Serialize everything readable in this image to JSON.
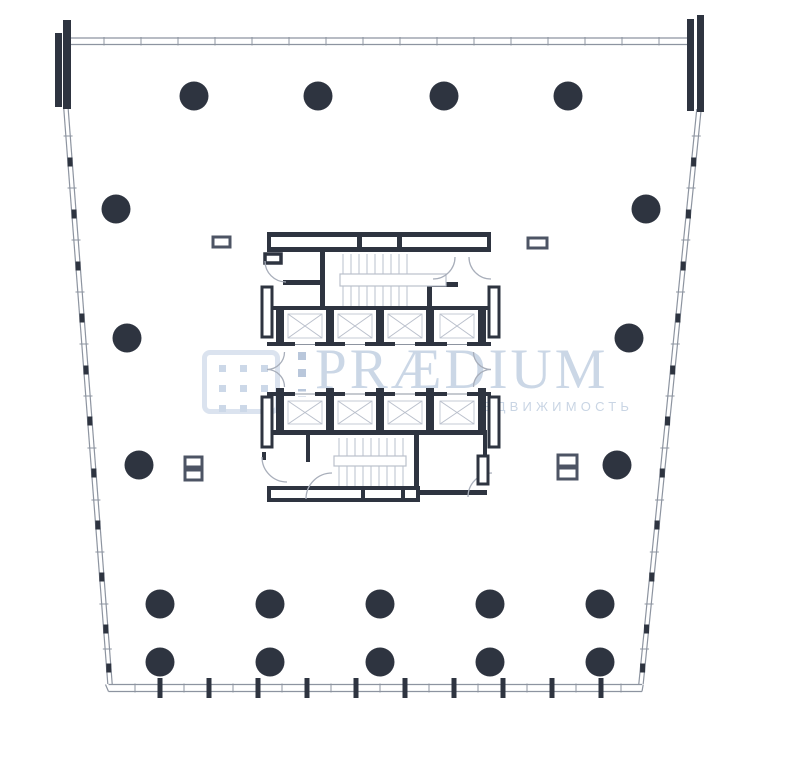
{
  "watermark": {
    "title": "PRÆDIUM",
    "subtitle": "КОММЕРЧЕСКАЯ НЕДВИЖИМОСТЬ",
    "logo": {
      "name": "praedium-building-grid-logo",
      "grid_rows": 3,
      "grid_cols": 3,
      "dot_size": 7,
      "grid_x0": 12,
      "grid_y0": 10,
      "grid_dx": 21,
      "grid_dy": 20,
      "strip_x": 298,
      "strip_dot_size": 8,
      "strip_ys": [
        352,
        369,
        389,
        405
      ]
    }
  },
  "colors": {
    "background": "#ffffff",
    "wall_dark": "#2e3440",
    "glazing_line": "#8d94a0",
    "detail_gray": "#bac0cc",
    "shaft_inner": "#c5cbd6",
    "vent_stroke": "#4d5464",
    "watermark_blue": "#cbd7e6"
  },
  "plan": {
    "column_radius": 14.5,
    "columns": [
      [
        194,
        96
      ],
      [
        318,
        96
      ],
      [
        444,
        96
      ],
      [
        568,
        96
      ],
      [
        116,
        209
      ],
      [
        646,
        209
      ],
      [
        127,
        338
      ],
      [
        629,
        338
      ],
      [
        139,
        465
      ],
      [
        617,
        465
      ],
      [
        160,
        604
      ],
      [
        270,
        604
      ],
      [
        380,
        604
      ],
      [
        490,
        604
      ],
      [
        600,
        604
      ],
      [
        160,
        662
      ],
      [
        270,
        662
      ],
      [
        380,
        662
      ],
      [
        490,
        662
      ],
      [
        600,
        662
      ]
    ],
    "perimeter": {
      "left": {
        "x0": 66,
        "y0": 109,
        "x1": 110,
        "y1": 684
      },
      "right": {
        "x0": 699,
        "y0": 109,
        "x1": 641,
        "y1": 684
      },
      "top_ticks_x": [
        104,
        141,
        178,
        215,
        252,
        289,
        326,
        363,
        400,
        437,
        474,
        511,
        548,
        585,
        622,
        659
      ],
      "bottom_ticks_light_x": [
        135,
        184,
        233,
        282,
        331,
        380,
        429,
        478,
        527,
        576,
        621
      ],
      "bottom_ticks_dark_x": [
        160,
        209,
        258,
        307,
        356,
        405,
        454,
        503,
        552,
        601
      ],
      "side_ticks_light_y": [
        136,
        188,
        240,
        292,
        344,
        396,
        448,
        500,
        552,
        604,
        649
      ],
      "side_ticks_dark_y": [
        162,
        214,
        266,
        318,
        370,
        421,
        473,
        525,
        577,
        629,
        668
      ]
    },
    "wall_bars": [
      [
        55,
        33,
        7,
        74
      ],
      [
        63,
        20,
        8,
        89
      ],
      [
        687,
        19,
        7,
        92
      ],
      [
        697,
        15,
        7,
        97
      ]
    ],
    "elevator_banks": [
      {
        "wall_top": [
          267,
          306,
          224,
          4
        ],
        "wall_bottom": [
          267,
          342,
          224,
          4
        ],
        "piers_x": [
          276,
          326,
          376,
          426,
          478
        ],
        "pier_w": 8,
        "pier_y": 306,
        "pier_h": 40,
        "shafts_x": [
          284,
          334,
          384,
          436
        ],
        "shaft_w": 42,
        "shaft_y": 310,
        "shaft_h": 32,
        "door_centers": [
          305,
          355,
          405,
          457
        ],
        "door_y": 342
      },
      {
        "wall_top": [
          267,
          392,
          224,
          4
        ],
        "wall_bottom": [
          267,
          430,
          220,
          5
        ],
        "piers_x": [
          276,
          326,
          376,
          426,
          478
        ],
        "pier_w": 8,
        "pier_y": 388,
        "pier_h": 44,
        "shafts_x": [
          284,
          334,
          384,
          436
        ],
        "shaft_w": 42,
        "shaft_y": 397,
        "shaft_h": 31,
        "door_centers": [
          305,
          355,
          405,
          457
        ],
        "door_y": 391.5
      }
    ],
    "stairs": [
      {
        "tread_x0": 343,
        "tread_dx": 8,
        "tread_n": 9,
        "tread_y0": 254,
        "tread_y1": 306,
        "landing": [
          340,
          274,
          106,
          12
        ]
      },
      {
        "tread_x0": 339,
        "tread_dx": 8,
        "tread_n": 9,
        "tread_y0": 438,
        "tread_y1": 486,
        "landing": [
          334,
          456,
          72,
          10
        ]
      }
    ],
    "vents": [
      [
        213,
        237,
        17,
        10
      ],
      [
        528,
        238,
        19,
        10
      ],
      [
        185,
        457,
        17,
        10
      ],
      [
        185,
        470,
        17,
        10
      ],
      [
        558,
        455,
        19,
        11
      ],
      [
        558,
        468,
        19,
        11
      ]
    ]
  }
}
